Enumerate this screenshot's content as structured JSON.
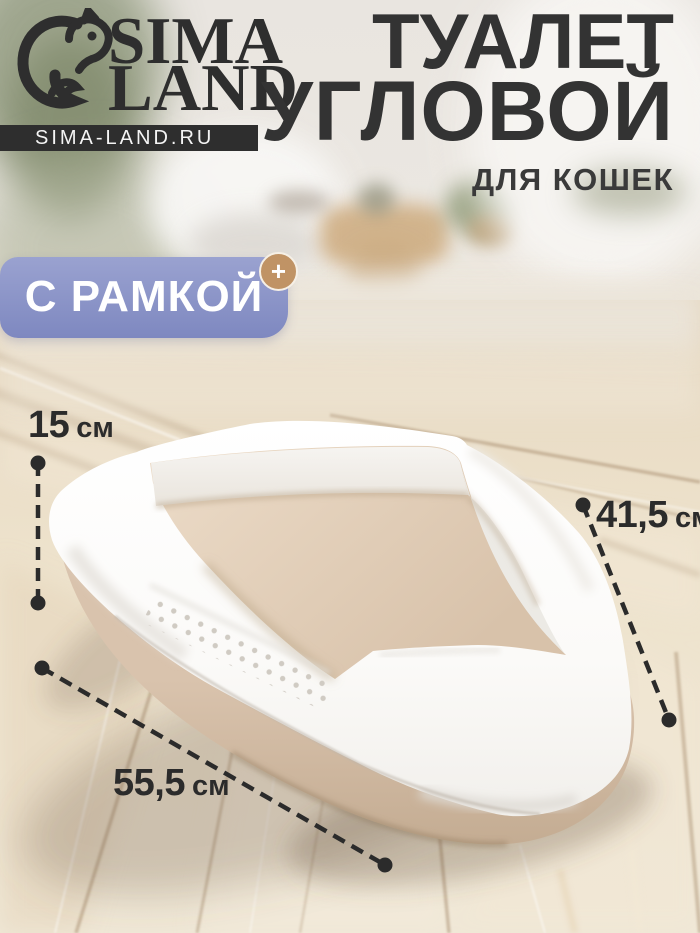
{
  "brand": {
    "logo": {
      "line1": "SIMA",
      "line2": "LAND",
      "icon": "squirrel-icon"
    },
    "website_bar": {
      "text": "SIMA-LAND.RU"
    }
  },
  "header": {
    "title_line1": "ТУАЛЕТ",
    "title_line2": "УГЛОВОЙ",
    "subtitle": "ДЛЯ КОШЕК"
  },
  "badge": {
    "label": "С РАМКОЙ",
    "plus": "+"
  },
  "dimensions": {
    "height": {
      "value": "15",
      "unit": "см"
    },
    "side": {
      "value": "41,5",
      "unit": "см"
    },
    "front": {
      "value": "55,5",
      "unit": "см"
    }
  },
  "colors": {
    "badge_background": "#8890c4",
    "badge_plus": "#c09365",
    "annotation_ink": "#2b2b2b",
    "frame_white": "#ffffff",
    "pan_beige": "#d9c3ac",
    "floor_wood": "#ecdfca"
  }
}
